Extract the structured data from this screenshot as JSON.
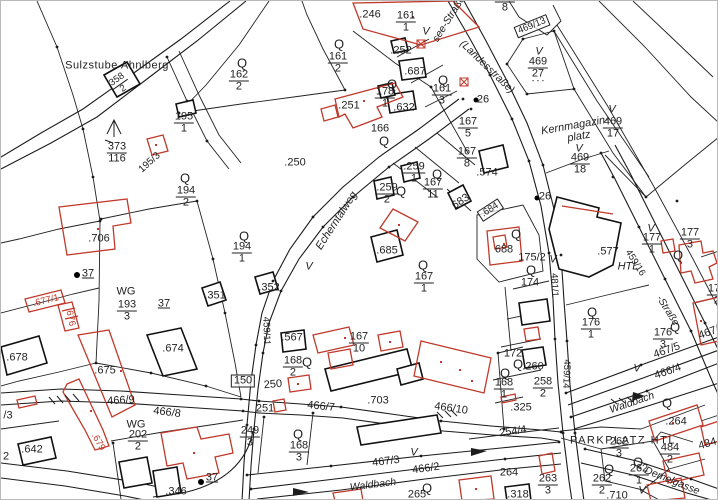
{
  "canvas": {
    "width": 718,
    "height": 500
  },
  "colors": {
    "ink": "#1f1f1f",
    "red": "#c0392b",
    "background": "#ffffff"
  },
  "map_type": "cadastral parcel map",
  "labels": [
    {
      "t": "Sulzstube Ahnlberg",
      "x": 116,
      "y": 65,
      "fs": 11,
      "ls": 0.5
    },
    {
      "f": "358/2",
      "x": 119,
      "y": 83,
      "r": -35,
      "fs": 9.5
    },
    {
      "f": "195/1",
      "x": 183,
      "y": 122
    },
    {
      "f": "373/116",
      "x": 116,
      "y": 152
    },
    {
      "t": "195/3",
      "x": 149,
      "y": 162,
      "r": -42,
      "fs": 10
    },
    {
      "t": "Q",
      "x": 241,
      "y": 62,
      "fs": 13
    },
    {
      "f": "162/2",
      "x": 238,
      "y": 80
    },
    {
      "t": "Q",
      "x": 184,
      "y": 177,
      "fs": 13
    },
    {
      "f": "194/2",
      "x": 185,
      "y": 196
    },
    {
      "t": ".706",
      "x": 98,
      "y": 238
    },
    {
      "t": "37",
      "x": 87,
      "y": 273,
      "u": 1
    },
    {
      "t": "WG",
      "x": 125,
      "y": 291
    },
    {
      "f": "193/3",
      "x": 126,
      "y": 310
    },
    {
      "t": "37",
      "x": 163,
      "y": 303,
      "u": 1
    },
    {
      "t": ".677/1",
      "x": 45,
      "y": 300,
      "r": -14,
      "c": "r",
      "fs": 9.5
    },
    {
      "t": ".676",
      "x": 69,
      "y": 316,
      "r": 78,
      "c": "r",
      "fs": 9.5
    },
    {
      "t": ".678",
      "x": 16,
      "y": 357
    },
    {
      "t": ".351",
      "x": 214,
      "y": 295
    },
    {
      "t": ".352",
      "x": 268,
      "y": 287
    },
    {
      "t": "Q",
      "x": 243,
      "y": 235,
      "fs": 13
    },
    {
      "f": "194/1",
      "x": 241,
      "y": 252
    },
    {
      "t": ".250",
      "x": 294,
      "y": 162
    },
    {
      "t": ".246",
      "x": 369,
      "y": 14
    },
    {
      "f": "161/1",
      "x": 405,
      "y": 21
    },
    {
      "t": "Q",
      "x": 338,
      "y": 43,
      "fs": 13
    },
    {
      "f": "161/2",
      "x": 337,
      "y": 62
    },
    {
      "t": ".252",
      "x": 400,
      "y": 50
    },
    {
      "t": ".687",
      "x": 414,
      "y": 71
    },
    {
      "t": "Q",
      "x": 391,
      "y": 83,
      "fs": 13
    },
    {
      "f": "178/1",
      "x": 384,
      "y": 97
    },
    {
      "t": ".632",
      "x": 403,
      "y": 107
    },
    {
      "t": ".251",
      "x": 348,
      "y": 105
    },
    {
      "t": "166",
      "x": 379,
      "y": 128
    },
    {
      "t": "Q",
      "x": 383,
      "y": 140,
      "fs": 13
    },
    {
      "t": "Q",
      "x": 442,
      "y": 79,
      "fs": 13
    },
    {
      "f": "161/3",
      "x": 441,
      "y": 94
    },
    {
      "t": "V",
      "x": 425,
      "y": 31,
      "i": 1
    },
    {
      "t": "see-Straße",
      "x": 448,
      "y": 18,
      "r": -58,
      "i": 1,
      "fs": 10.5
    },
    {
      "t": "(Landesstraße)",
      "x": 486,
      "y": 66,
      "r": 44,
      "i": 1,
      "fs": 10.5
    },
    {
      "f": "167/5",
      "x": 467,
      "y": 127
    },
    {
      "f": "167/8",
      "x": 466,
      "y": 157
    },
    {
      "t": "26",
      "x": 482,
      "y": 99
    },
    {
      "f": "162/8",
      "x": 504,
      "y": 1
    },
    {
      "t": "469/13",
      "x": 531,
      "y": 25,
      "r": -22,
      "box": 1,
      "fs": 9.5
    },
    {
      "t": "V",
      "x": 538,
      "y": 51,
      "i": 1
    },
    {
      "f": "469/27",
      "x": 537,
      "y": 67
    },
    {
      "t": "- - -",
      "x": 537,
      "y": 80,
      "fs": 8
    },
    {
      "t": "Kernmagazin-",
      "x": 574,
      "y": 125,
      "r": -10,
      "i": 1
    },
    {
      "t": "platz",
      "x": 578,
      "y": 136,
      "r": -10,
      "i": 1
    },
    {
      "t": "V",
      "x": 611,
      "y": 109,
      "i": 1
    },
    {
      "f": "469/17",
      "x": 612,
      "y": 127
    },
    {
      "t": "V",
      "x": 578,
      "y": 148,
      "i": 1
    },
    {
      "f": "469/18",
      "x": 579,
      "y": 163
    },
    {
      "t": "Echerntalweg",
      "x": 336,
      "y": 220,
      "r": -57,
      "i": 1
    },
    {
      "f": ".259/2",
      "x": 386,
      "y": 193
    },
    {
      "t": "Q",
      "x": 400,
      "y": 190,
      "fs": 13
    },
    {
      "f": ".259/1",
      "x": 413,
      "y": 172
    },
    {
      "t": "Q",
      "x": 436,
      "y": 173,
      "fs": 13
    },
    {
      "f": "167/11",
      "x": 432,
      "y": 188
    },
    {
      "t": "683",
      "x": 460,
      "y": 201,
      "r": -33
    },
    {
      "t": ".684",
      "x": 489,
      "y": 209,
      "r": -33,
      "box": 1,
      "fs": 9.5
    },
    {
      "t": ".685",
      "x": 386,
      "y": 250
    },
    {
      "t": "Q",
      "x": 422,
      "y": 264,
      "fs": 13
    },
    {
      "f": "167/1",
      "x": 423,
      "y": 282
    },
    {
      "t": "V",
      "x": 308,
      "y": 266,
      "i": 1
    },
    {
      "t": "459/11",
      "x": 265,
      "y": 330,
      "r": 88,
      "fs": 9.5
    },
    {
      "t": ".574",
      "x": 486,
      "y": 172
    },
    {
      "t": "Q",
      "x": 515,
      "y": 233,
      "fs": 13
    },
    {
      "t": "688",
      "x": 503,
      "y": 249
    },
    {
      "t": "175/2",
      "x": 531,
      "y": 257
    },
    {
      "t": "Q",
      "x": 530,
      "y": 269,
      "fs": 13
    },
    {
      "t": "174",
      "x": 529,
      "y": 282
    },
    {
      "t": "26",
      "x": 544,
      "y": 196
    },
    {
      "t": "V",
      "x": 552,
      "y": 259,
      "i": 1
    },
    {
      "t": "481/1",
      "x": 553,
      "y": 284,
      "r": 88,
      "fs": 9.5
    },
    {
      "t": ".577",
      "x": 607,
      "y": 251
    },
    {
      "t": "HTL",
      "x": 627,
      "y": 266,
      "i": 1
    },
    {
      "t": "V",
      "x": 650,
      "y": 228,
      "i": 1
    },
    {
      "f": "177/1",
      "x": 651,
      "y": 243
    },
    {
      "f": "177/3",
      "x": 689,
      "y": 238
    },
    {
      "t": "Q",
      "x": 677,
      "y": 254,
      "fs": 13
    },
    {
      "t": "459/16",
      "x": 634,
      "y": 262,
      "r": 58,
      "fs": 9.5
    },
    {
      "t": "-Straße",
      "x": 666,
      "y": 310,
      "r": 58,
      "i": 1,
      "fs": 10
    },
    {
      "t": "Q",
      "x": 591,
      "y": 311,
      "fs": 13
    },
    {
      "f": "176/1",
      "x": 590,
      "y": 328
    },
    {
      "t": "Q",
      "x": 674,
      "y": 326,
      "fs": 13
    },
    {
      "f": "176/3",
      "x": 662,
      "y": 338
    },
    {
      "t": "467/5",
      "x": 666,
      "y": 350,
      "r": -20
    },
    {
      "t": "466/4",
      "x": 667,
      "y": 371,
      "r": -19
    },
    {
      "t": "467/6",
      "x": 711,
      "y": 331,
      "r": -20
    },
    {
      "f": "172/2",
      "x": 716,
      "y": 294
    },
    {
      "t": "459/14",
      "x": 565,
      "y": 373,
      "r": 92,
      "fs": 9.5
    },
    {
      "t": "Waldbach",
      "x": 631,
      "y": 402,
      "r": -19,
      "i": 1,
      "fs": 10.5
    },
    {
      "t": "Waldbach",
      "x": 372,
      "y": 484,
      "r": -7,
      "i": 1,
      "fs": 10.5
    },
    {
      "t": "467/3",
      "x": 385,
      "y": 461,
      "r": -7
    },
    {
      "t": "V",
      "x": 413,
      "y": 452,
      "i": 1
    },
    {
      "t": "466/2",
      "x": 425,
      "y": 468,
      "r": -8
    },
    {
      "t": "Q",
      "x": 504,
      "y": 372,
      "fs": 13
    },
    {
      "f": "168/1",
      "x": 503,
      "y": 388
    },
    {
      "t": "172",
      "x": 512,
      "y": 353
    },
    {
      "t": "Q",
      "x": 517,
      "y": 363,
      "fs": 13
    },
    {
      "t": ".260",
      "x": 532,
      "y": 366
    },
    {
      "f": "258/2",
      "x": 542,
      "y": 387
    },
    {
      "t": ".325",
      "x": 520,
      "y": 407
    },
    {
      "t": "254/4",
      "x": 512,
      "y": 431,
      "r": -8
    },
    {
      "t": "Q",
      "x": 666,
      "y": 402,
      "fs": 13
    },
    {
      "t": ".264",
      "x": 675,
      "y": 421
    },
    {
      "t": "PARKPLATZ HTL",
      "x": 622,
      "y": 440,
      "fs": 11,
      "ls": 1.5
    },
    {
      "f": "262/3",
      "x": 618,
      "y": 447
    },
    {
      "t": "Q",
      "x": 637,
      "y": 461,
      "fs": 13
    },
    {
      "f": "262/1",
      "x": 638,
      "y": 474
    },
    {
      "t": "Q",
      "x": 608,
      "y": 468,
      "fs": 13
    },
    {
      "f": "262/2",
      "x": 601,
      "y": 484
    },
    {
      "f": "484/2",
      "x": 669,
      "y": 453
    },
    {
      "t": "484/1",
      "x": 711,
      "y": 442,
      "r": -16
    },
    {
      "t": "Demelgasse",
      "x": 671,
      "y": 480,
      "r": 22,
      "i": 1,
      "fs": 10.5
    },
    {
      "t": "V",
      "x": 641,
      "y": 490,
      "i": 1
    },
    {
      "t": ".710",
      "x": 616,
      "y": 495
    },
    {
      "t": "265",
      "x": 416,
      "y": 494
    },
    {
      "t": "Q",
      "x": 426,
      "y": 487,
      "fs": 13
    },
    {
      "f": "263/3",
      "x": 547,
      "y": 484
    },
    {
      "t": ".318",
      "x": 517,
      "y": 494
    },
    {
      "t": "264",
      "x": 508,
      "y": 472
    },
    {
      "t": ".567",
      "x": 291,
      "y": 337
    },
    {
      "t": "Q",
      "x": 306,
      "y": 361,
      "fs": 13
    },
    {
      "f": "168/2",
      "x": 292,
      "y": 366
    },
    {
      "f": "167/10",
      "x": 358,
      "y": 342
    },
    {
      "t": "150",
      "x": 242,
      "y": 380,
      "box": 1
    },
    {
      "t": "250",
      "x": 272,
      "y": 384,
      "r": -5
    },
    {
      "t": "251",
      "x": 264,
      "y": 408
    },
    {
      "t": "466/7",
      "x": 320,
      "y": 406,
      "r": 6
    },
    {
      "t": ".703",
      "x": 377,
      "y": 400
    },
    {
      "t": "466/10",
      "x": 450,
      "y": 408,
      "r": 8
    },
    {
      "f": "249/3",
      "x": 249,
      "y": 436
    },
    {
      "t": "Q",
      "x": 297,
      "y": 433,
      "fs": 13
    },
    {
      "f": "168/3",
      "x": 298,
      "y": 451
    },
    {
      "t": ".346",
      "x": 175,
      "y": 491
    },
    {
      "t": "37",
      "x": 211,
      "y": 477,
      "u": 1
    },
    {
      "f": "202/2",
      "x": 137,
      "y": 440
    },
    {
      "t": "WG",
      "x": 135,
      "y": 424
    },
    {
      "t": ".675",
      "x": 104,
      "y": 370
    },
    {
      "t": ".674",
      "x": 172,
      "y": 348
    },
    {
      "t": "466/9",
      "x": 120,
      "y": 400,
      "r": -3
    },
    {
      "t": "466/8",
      "x": 166,
      "y": 412,
      "r": 7
    },
    {
      "t": ".679",
      "x": 97,
      "y": 441,
      "r": 60,
      "c": "r",
      "fs": 9.5
    },
    {
      "t": ".642",
      "x": 31,
      "y": 449
    },
    {
      "t": "/3",
      "x": 7,
      "y": 415
    },
    {
      "t": "2",
      "x": 5,
      "y": 456
    },
    {
      "t": "V",
      "x": 636,
      "y": 368,
      "i": 1
    }
  ]
}
